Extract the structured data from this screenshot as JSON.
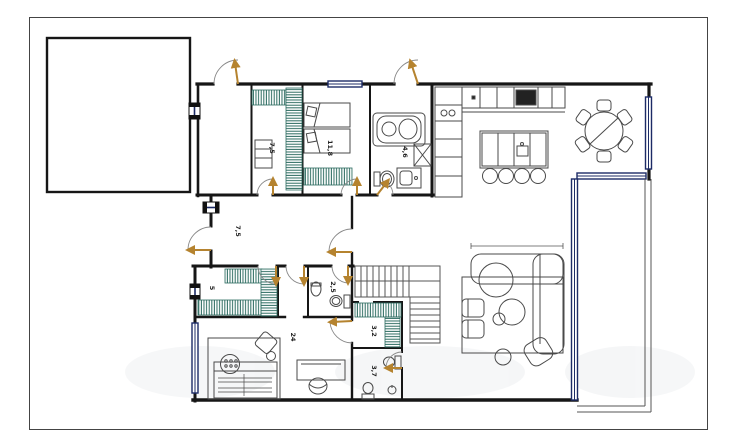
{
  "plan": {
    "title": "apartment-floor-plan",
    "rooms": [
      {
        "name": "dressing-room",
        "label": "7,5"
      },
      {
        "name": "bedroom-twin",
        "label": "11,8"
      },
      {
        "name": "bathroom-main",
        "label": "4,6"
      },
      {
        "name": "hallway",
        "label": "7,5"
      },
      {
        "name": "wardrobe-room",
        "label": "5"
      },
      {
        "name": "bathroom-small",
        "label": "2,5"
      },
      {
        "name": "bedroom-large",
        "label": "24"
      },
      {
        "name": "closet",
        "label": "3,2"
      },
      {
        "name": "wc",
        "label": "3,7"
      }
    ],
    "colors": {
      "wall": "#161616",
      "furniture_line": "#4a4a4a",
      "window": "#1c2b66",
      "door_leaf": "#b5832f",
      "wardrobe_hatch": "#2c6b60"
    }
  }
}
